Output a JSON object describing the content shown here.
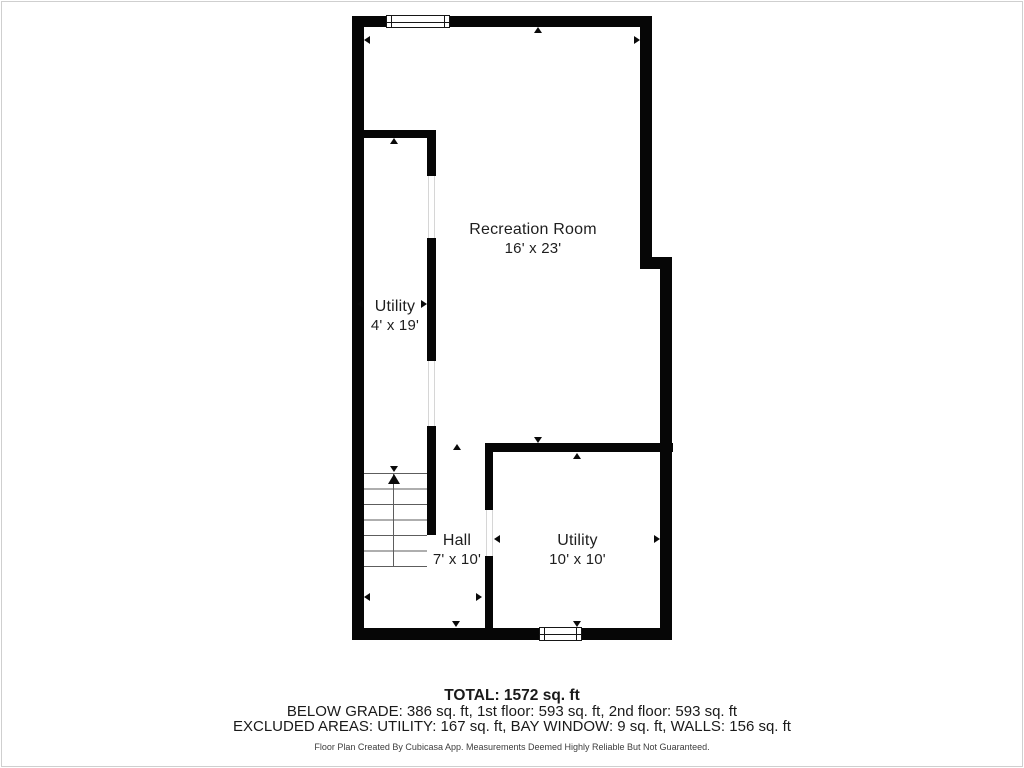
{
  "plan": {
    "rooms": [
      {
        "id": "recreation-room",
        "name": "Recreation Room",
        "dims": "16' x 23'"
      },
      {
        "id": "utility-small",
        "name": "Utility",
        "dims": "4' x 19'"
      },
      {
        "id": "hall",
        "name": "Hall",
        "dims": "7' x 10'"
      },
      {
        "id": "utility-large",
        "name": "Utility",
        "dims": "10' x 10'"
      }
    ],
    "symbols": {
      "window": "double-line window symbol",
      "stairs": "switchback stairs with up-direction arrow",
      "measure_marker": "small black triangle arrow"
    }
  },
  "summary": {
    "total": "TOTAL: 1572 sq. ft",
    "floors": "BELOW GRADE: 386 sq. ft, 1st floor: 593 sq. ft, 2nd floor: 593 sq. ft",
    "excluded": "EXCLUDED AREAS: UTILITY: 167 sq. ft, BAY WINDOW: 9 sq. ft, WALLS: 156 sq. ft",
    "disclaimer": "Floor Plan Created By Cubicasa App. Measurements Deemed Highly Reliable But Not Guaranteed."
  },
  "colors": {
    "wall": "#060606",
    "text": "#1e1e1e",
    "tread_line": "#5d5d5d",
    "door_gap_line": "#d6d6d6",
    "page_border": "#cfcfcf",
    "background": "#ffffff"
  }
}
